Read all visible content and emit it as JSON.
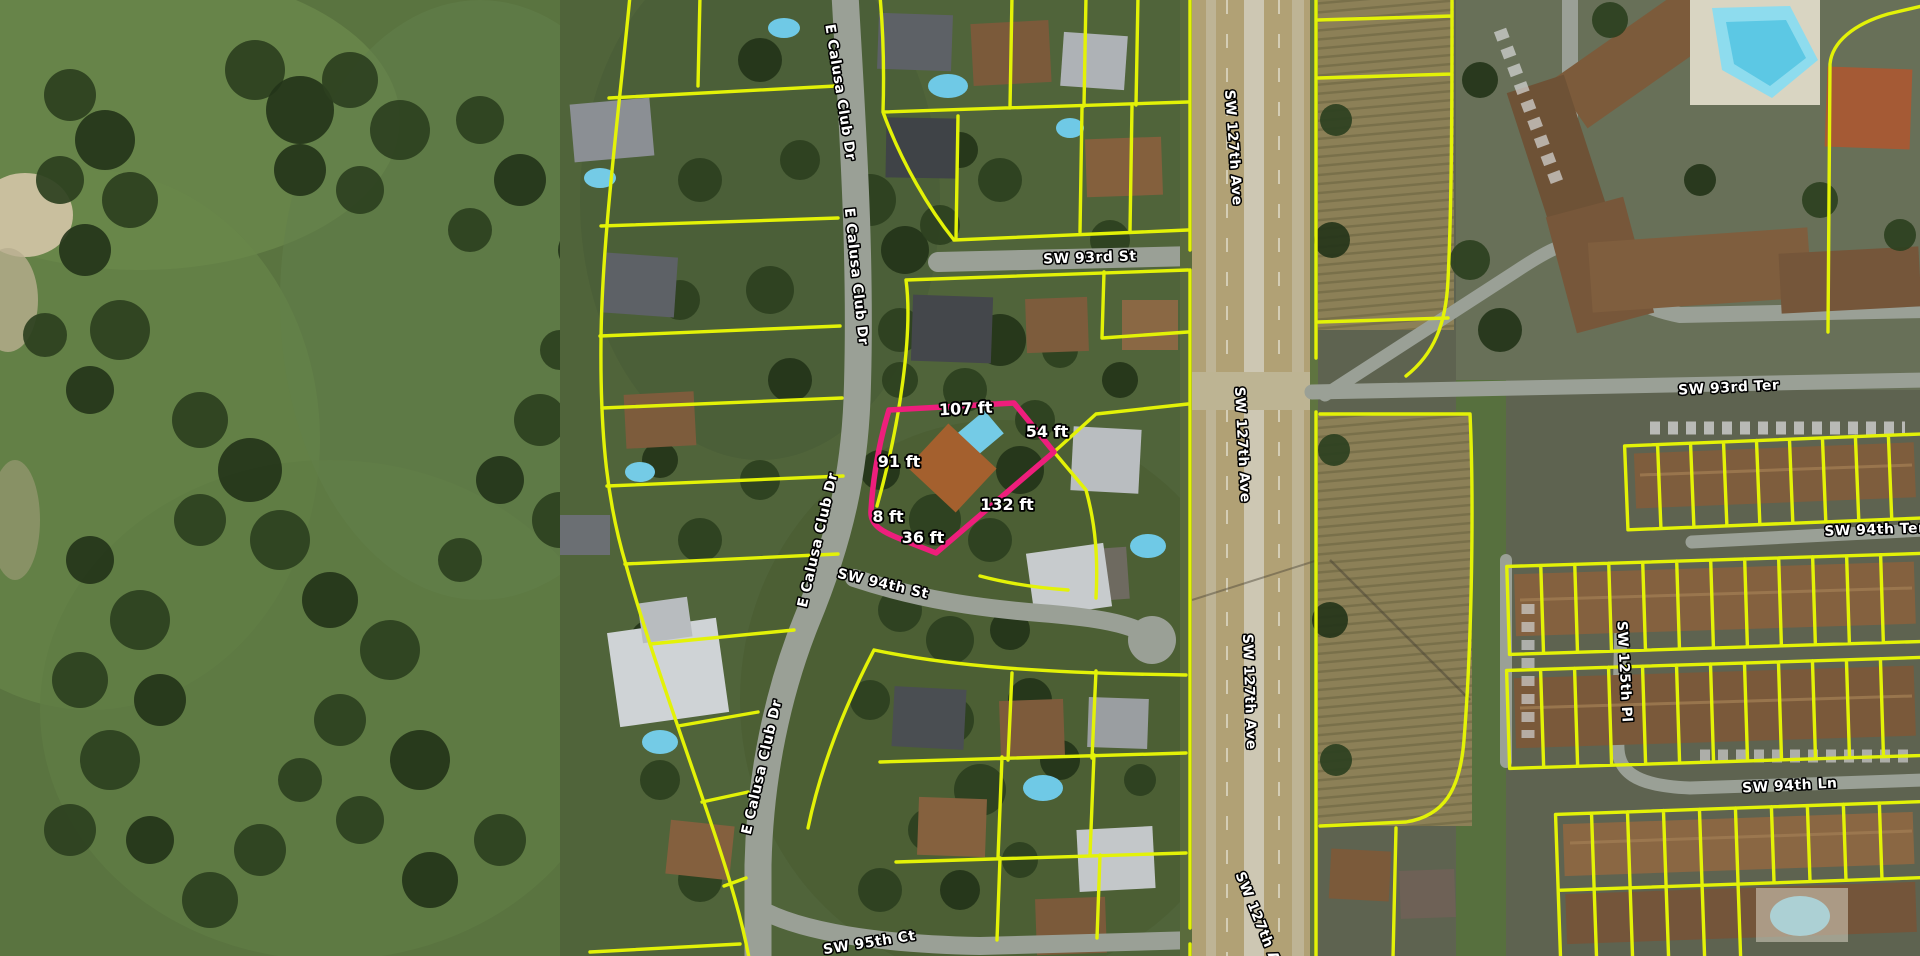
{
  "map": {
    "description": "Aerial parcel viewer with highlighted lot and edge dimensions",
    "colors": {
      "parcel_line": "#e3f207",
      "highlight_line": "#ee1e7c",
      "label_fill": "#ffffff",
      "label_halo": "#000000"
    },
    "street_labels": [
      {
        "id": "e-calusa-club-dr-1",
        "text": "E Calusa Club Dr"
      },
      {
        "id": "e-calusa-club-dr-2",
        "text": "E Calusa Club Dr"
      },
      {
        "id": "e-calusa-club-dr-3",
        "text": "E Calusa Club Dr"
      },
      {
        "id": "e-calusa-club-dr-4",
        "text": "E Calusa Club Dr"
      },
      {
        "id": "sw-93rd-st",
        "text": "SW 93rd St"
      },
      {
        "id": "sw-94th-st",
        "text": "SW 94th St"
      },
      {
        "id": "sw-95th-ct",
        "text": "SW 95th Ct"
      },
      {
        "id": "sw-127th-ave-1",
        "text": "SW 127th Ave"
      },
      {
        "id": "sw-127th-ave-2",
        "text": "SW 127th Ave"
      },
      {
        "id": "sw-127th-ave-3",
        "text": "SW 127th Ave"
      },
      {
        "id": "sw-127th-ave-4",
        "text": "SW 127th Ave"
      },
      {
        "id": "sw-93rd-ter",
        "text": "SW 93rd Ter"
      },
      {
        "id": "sw-94th-ter",
        "text": "SW 94th Ter"
      },
      {
        "id": "sw-125th-pl",
        "text": "SW 125th Pl"
      },
      {
        "id": "sw-94th-ln",
        "text": "SW 94th Ln"
      }
    ],
    "highlighted_parcel": {
      "dimension_labels": [
        "107 ft",
        "54 ft",
        "91 ft",
        "132 ft",
        "8 ft",
        "36 ft"
      ]
    }
  }
}
